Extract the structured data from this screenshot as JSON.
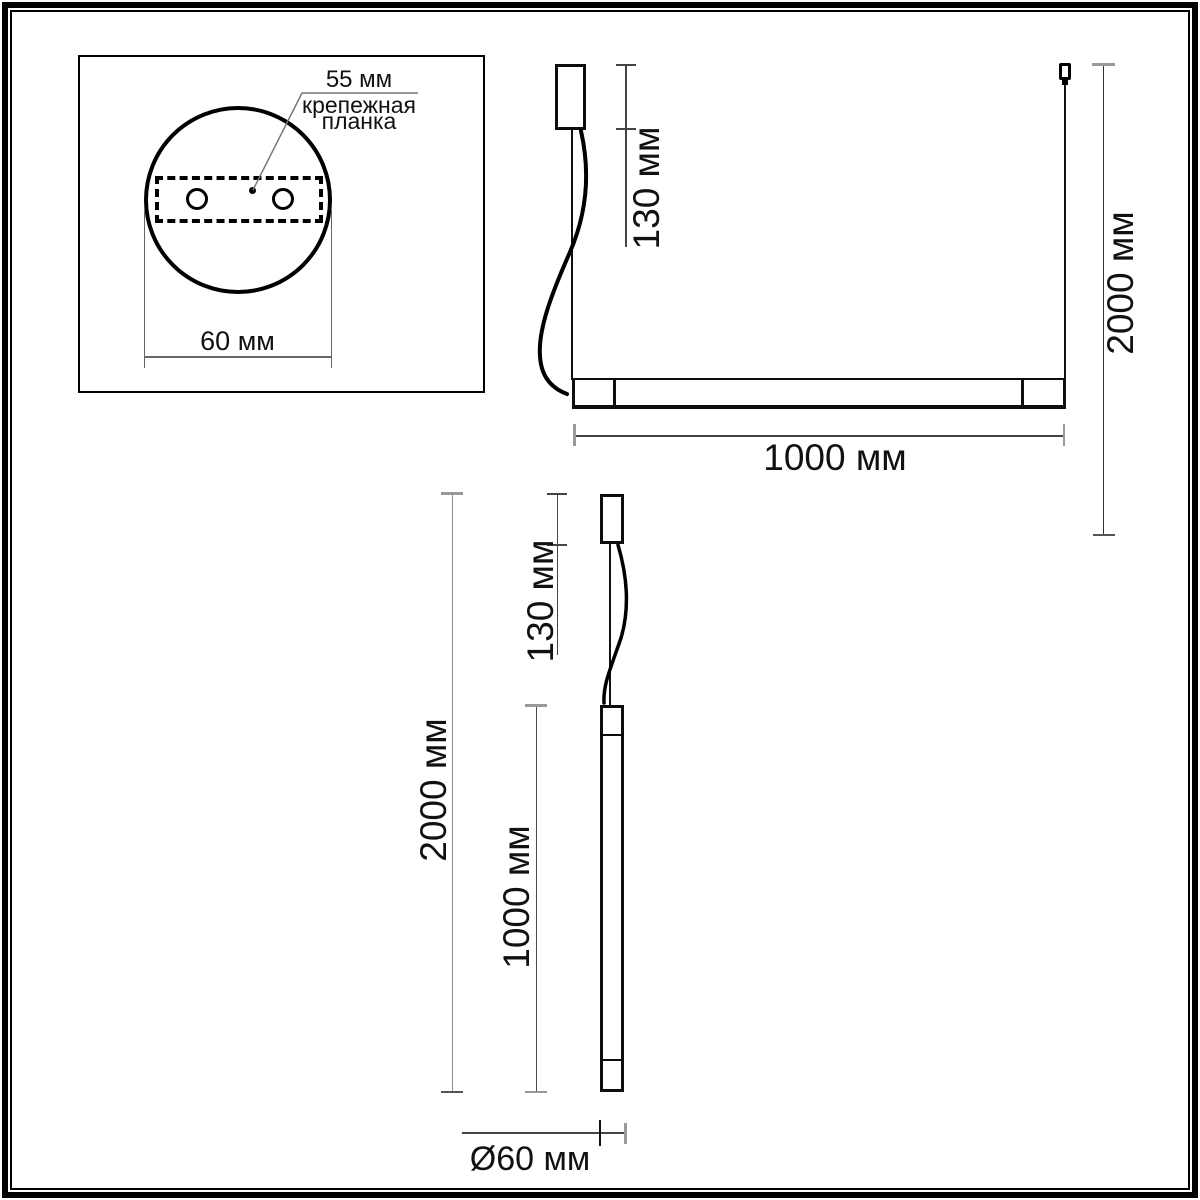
{
  "drawing": {
    "type": "pendant-light-dimension-drawing",
    "mount_detail": {
      "dim_plate_width": "55 мм",
      "plate_label_line1": "крепежная",
      "plate_label_line2": "планка",
      "dim_canopy_diameter": "60 мм"
    },
    "horizontal_view": {
      "dim_canopy_height": "130 мм",
      "dim_suspension": "2000 мм",
      "dim_bar_length": "1000 мм"
    },
    "vertical_view": {
      "dim_canopy_height": "130 мм",
      "dim_suspension": "2000 мм",
      "dim_tube_length": "1000 мм",
      "dim_tube_diameter": "Ø60 мм"
    },
    "colors": {
      "outline": "#0d0d0d",
      "dim_line": "#444444",
      "dim_tick": "#999999",
      "leader": "#777777",
      "text": "#111111"
    }
  }
}
